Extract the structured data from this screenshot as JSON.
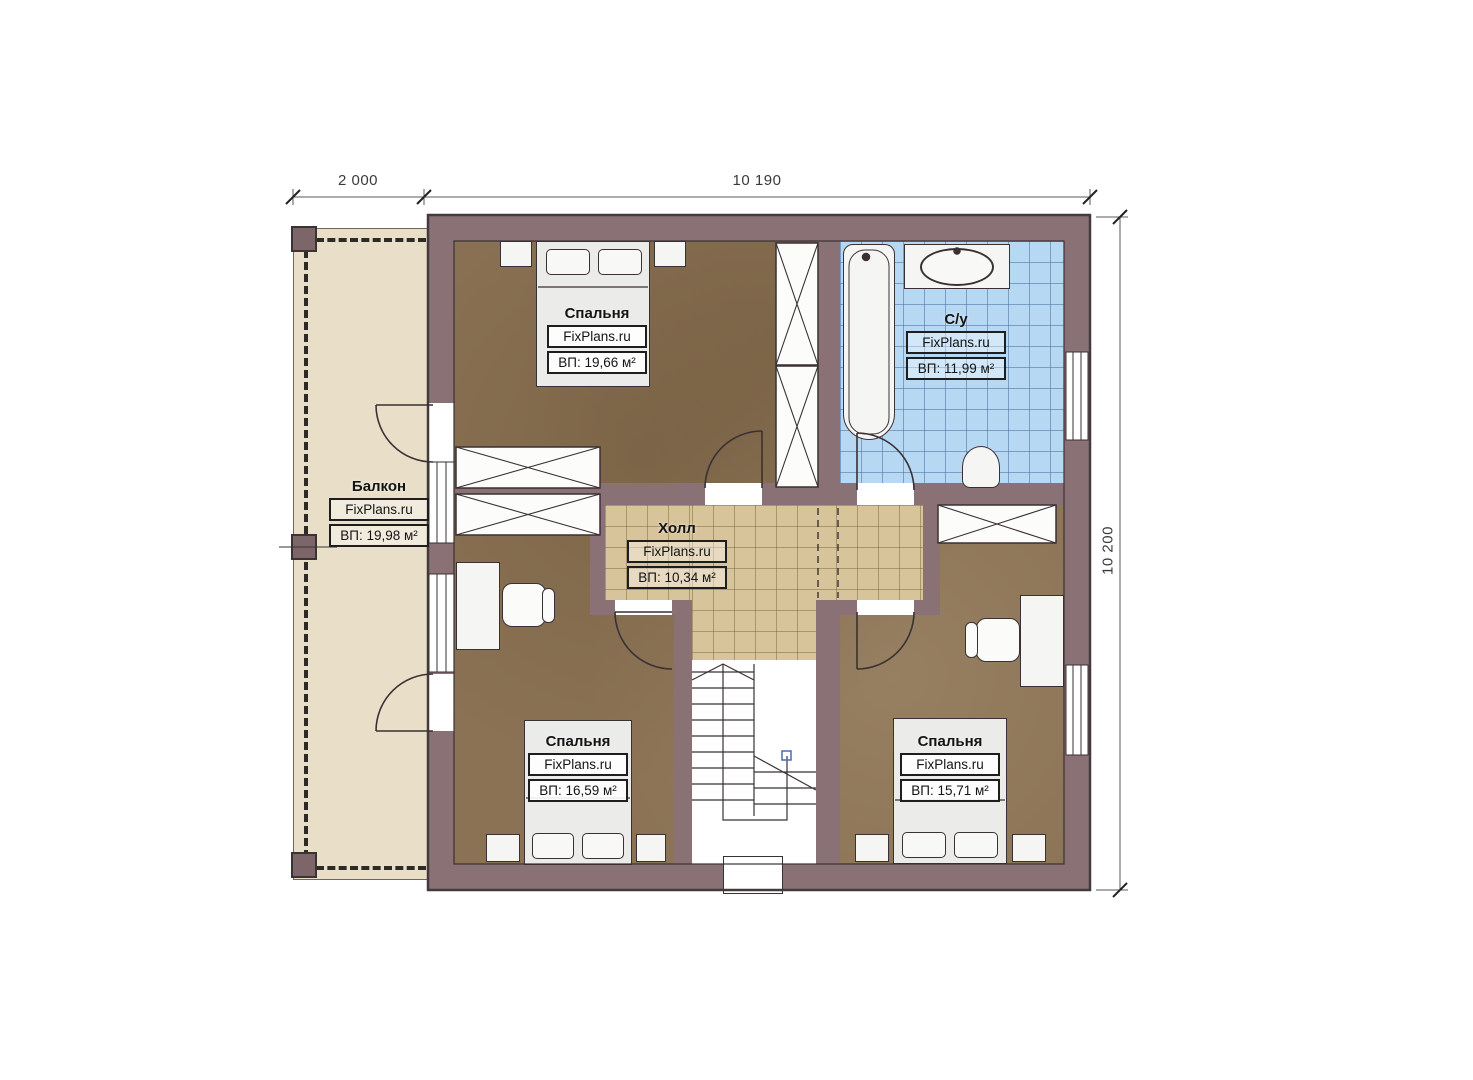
{
  "plan": {
    "dimensions": {
      "top_left": "2 000",
      "top_right": "10 190",
      "right_side": "10 200"
    },
    "rooms": [
      {
        "id": "bedroom-top-left",
        "name": "Спальня",
        "brand": "FixPlans.ru",
        "area": "ВП: 19,66 м²"
      },
      {
        "id": "bathroom",
        "name": "С/у",
        "brand": "FixPlans.ru",
        "area": "ВП: 11,99 м²"
      },
      {
        "id": "balcony",
        "name": "Балкон",
        "brand": "FixPlans.ru",
        "area": "ВП: 19,98 м²"
      },
      {
        "id": "hall",
        "name": "Холл",
        "brand": "FixPlans.ru",
        "area": "ВП: 10,34 м²"
      },
      {
        "id": "bedroom-bottom-left",
        "name": "Спальня",
        "brand": "FixPlans.ru",
        "area": "ВП: 16,59 м²"
      },
      {
        "id": "bedroom-bottom-right",
        "name": "Спальня",
        "brand": "FixPlans.ru",
        "area": "ВП: 15,71 м²"
      }
    ],
    "colors": {
      "wall": "#8a7175",
      "bedroom_floor": "#8b7254",
      "bathroom_tile": "#b7d8f3",
      "hall_tile": "#d8c49a",
      "balcony_floor": "#e9dfc9",
      "line": "#3a3134"
    }
  }
}
